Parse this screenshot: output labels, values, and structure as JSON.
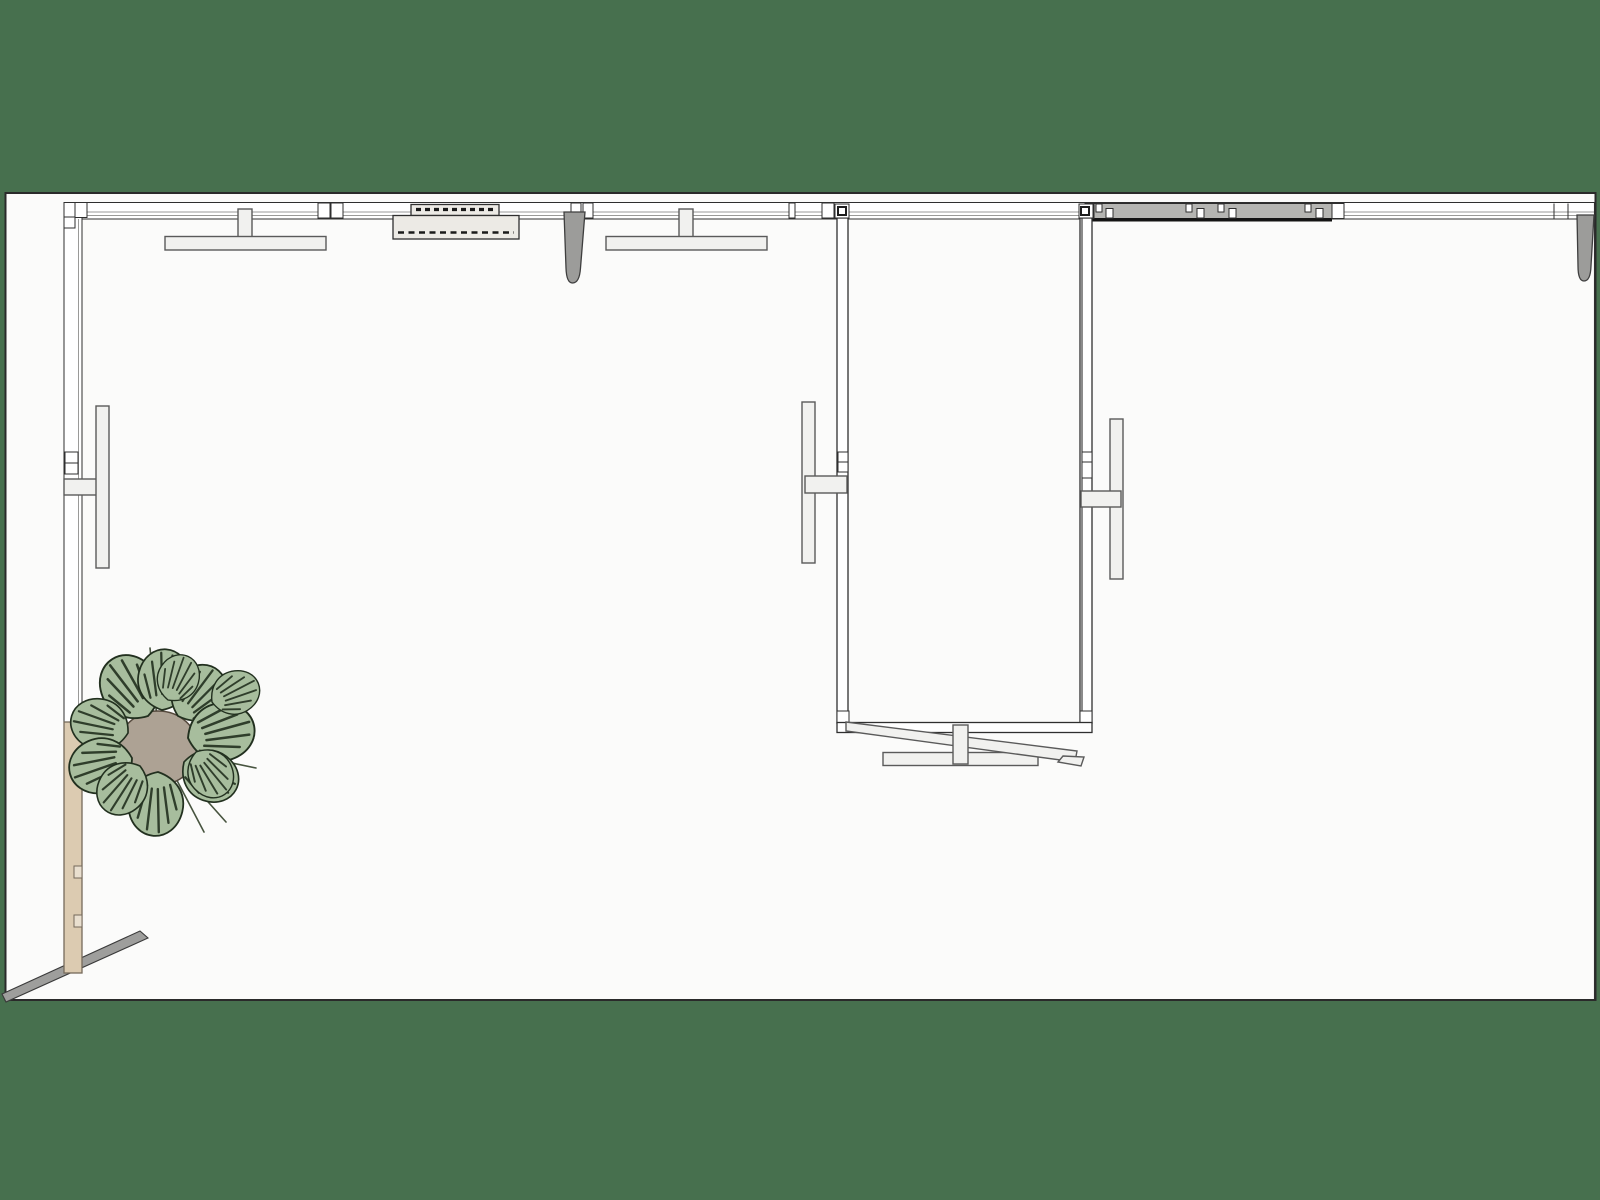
{
  "scene": {
    "description": "Top-down orthographic plan view of a gallery-like interior model on a green background: perimeter walls with wall-mounted light bars, a ventilation unit, a ceiling track, two tapered pendants, an inner room with side light bars and a tilted rail at its opening, a timber column and a potted monstera plant at the lower left.",
    "objects": [
      {
        "name": "floor-canvas",
        "label": "White floor plane"
      },
      {
        "name": "top-wall",
        "label": "Top perimeter wall"
      },
      {
        "name": "left-wall",
        "label": "Left perimeter wall"
      },
      {
        "name": "right-wall-edge",
        "label": "Right perimeter wall edge"
      },
      {
        "name": "wall-light-1",
        "label": "Wall-mounted light bar"
      },
      {
        "name": "wall-light-2",
        "label": "Wall-mounted light bar"
      },
      {
        "name": "left-wall-light",
        "label": "Wall-mounted light bar"
      },
      {
        "name": "ac-unit",
        "label": "Ventilation / AC unit with louvers"
      },
      {
        "name": "ceiling-track",
        "label": "Ceiling track with hangers"
      },
      {
        "name": "pendant-1",
        "label": "Tapered pendant fitting"
      },
      {
        "name": "pendant-2",
        "label": "Tapered pendant fitting"
      },
      {
        "name": "inner-room",
        "label": "Inner room enclosure"
      },
      {
        "name": "room-light-left",
        "label": "Room side light bar"
      },
      {
        "name": "room-light-right",
        "label": "Room side light bar"
      },
      {
        "name": "room-bottom-fixture",
        "label": "Bottom light bar with tilted rail"
      },
      {
        "name": "timber-column",
        "label": "Timber wall column"
      },
      {
        "name": "floor-rail",
        "label": "Diagonal floor rail"
      },
      {
        "name": "monstera-plant",
        "label": "Potted monstera plant (top view)"
      }
    ]
  },
  "colors": {
    "bg": "#47704E",
    "canvas": "#FBFBFA",
    "line": "#2F2F2F",
    "line_soft": "#5A5A5A",
    "wall_fill": "#FFFFFF",
    "fixture_fill": "#F1F1EF",
    "unit_fill": "#ECEAE5",
    "pendant_gray": "#9C9C9A",
    "track_gray": "#B5B5B2",
    "track_shadow": "#141414",
    "metal_gray": "#9E9E9C",
    "wall_beige": "#DCCBB1",
    "beige_line": "#756A5B",
    "leaf_fill": "#A7BD9D",
    "leaf_line": "#22301F",
    "stem_line": "#47543F",
    "pot_fill": "#ADA294",
    "pot_line": "#55493D"
  }
}
